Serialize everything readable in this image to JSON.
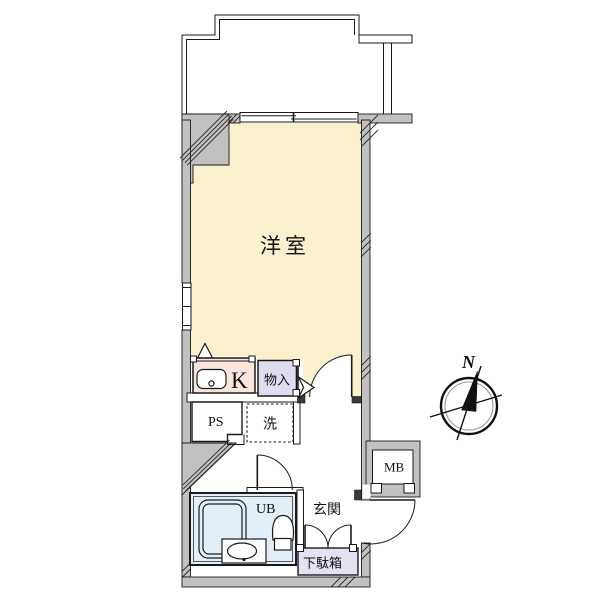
{
  "plan": {
    "type": "apartment-floor-plan",
    "labels": {
      "main_room": "洋室",
      "kitchen": "K",
      "closet": "物入",
      "pipe_space": "PS",
      "laundry": "洗",
      "unit_bath": "UB",
      "entrance": "玄関",
      "shoe_box": "下駄箱",
      "meter_box": "MB"
    },
    "compass": {
      "north_label": "N"
    },
    "colors": {
      "main_room": "#faf0ce",
      "kitchen": "#fae5dc",
      "closet": "#dedcee",
      "unit_bath": "#e2eff9",
      "shoe_box": "#e3e1f2",
      "wall": "#c1c1c1",
      "line": "#1a1a1a",
      "background": "#ffffff"
    }
  }
}
